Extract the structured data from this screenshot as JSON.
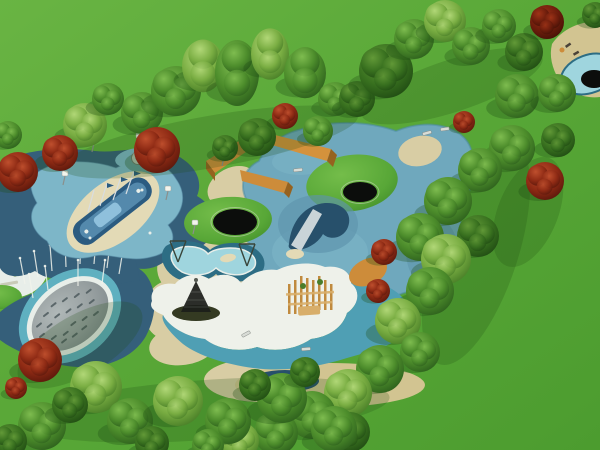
{
  "meta": {
    "description": "Aerial 3D rendering of a children's playground park with tree bands, navy and blue safety surfacing, splash pad with water jets, wading pool, white lagoon with cone climber, trampolines, orange wall and corner pool"
  },
  "palette": {
    "shadow": "#1e4c14",
    "navy": "#355f7a",
    "navyDeep": "#27506b",
    "blueLight": "#7db6c8",
    "blueMid": "#6fa8bd",
    "blueSteel": "#5d93ac",
    "blueEdge": "#4a8aa2",
    "poolBorder": "#2d6d84",
    "poolWater": "#9fd5de",
    "rim": "#e8eee9",
    "tealBand": "#4f9fb4",
    "tealRing": "#5fb0c0",
    "sand": "#d8cda4",
    "sandLight": "#e3dab6",
    "tanDeck": "#d2c491",
    "white": "#eef1ea",
    "grayDash": "#4e5a5e",
    "orange": "#cd8c3a",
    "orangeBright": "#d4923c",
    "orangeDark": "#96621f",
    "hull": "#2b5b80",
    "hullLight": "#5c92b4",
    "cabin": "#8fc0dc",
    "cone": "#1c1e1a",
    "mound": "#343a22",
    "structTan": "#c08a3e",
    "structTanLight": "#d8ae6a",
    "structGreen": "#4a7d2a",
    "lamp": "#f2f4ec",
    "pole": "#8a8f8c",
    "slide": "#c9d4d8",
    "black": "#0c0d0c",
    "benchGray": "#d8dcd6",
    "frame": "#39453a",
    "deckItemDark": "#4a4238"
  },
  "gradients": {
    "grassBG": {
      "type": "linear",
      "stops": [
        [
          "0%",
          "#69b443"
        ],
        [
          "55%",
          "#57a636"
        ],
        [
          "100%",
          "#4c9c2f"
        ]
      ]
    },
    "tree_g": {
      "type": "radial",
      "stops": [
        [
          "0%",
          "#7fbd50"
        ],
        [
          "55%",
          "#4c8c2b"
        ],
        [
          "100%",
          "#27571a"
        ]
      ]
    },
    "tree_l": {
      "type": "radial",
      "stops": [
        [
          "0%",
          "#b2d878"
        ],
        [
          "55%",
          "#79ad42"
        ],
        [
          "100%",
          "#3f7522"
        ]
      ]
    },
    "tree_d": {
      "type": "radial",
      "stops": [
        [
          "0%",
          "#639a38"
        ],
        [
          "55%",
          "#38701f"
        ],
        [
          "100%",
          "#1c4511"
        ]
      ]
    },
    "tree_r": {
      "type": "radial",
      "stops": [
        [
          "0%",
          "#c0502e"
        ],
        [
          "55%",
          "#8e2a14"
        ],
        [
          "100%",
          "#50140a"
        ]
      ]
    },
    "tree_rd": {
      "type": "radial",
      "stops": [
        [
          "0%",
          "#a03418"
        ],
        [
          "55%",
          "#6d1d0c"
        ],
        [
          "100%",
          "#3d0f05"
        ]
      ]
    },
    "padGrad": {
      "type": "radial",
      "stops": [
        [
          "0%",
          "#b0b8b8"
        ],
        [
          "60%",
          "#979fa0"
        ],
        [
          "100%",
          "#7f898c"
        ]
      ]
    },
    "moundGrad": {
      "type": "radial",
      "stops": [
        [
          "0%",
          "#74bd4a"
        ],
        [
          "70%",
          "#58a737"
        ],
        [
          "100%",
          "#44902c"
        ]
      ]
    }
  },
  "trees": [
    [
      8,
      135,
      14,
      "g"
    ],
    [
      85,
      125,
      22,
      "l"
    ],
    [
      108,
      99,
      16,
      "g"
    ],
    [
      60,
      153,
      18,
      "r"
    ],
    [
      18,
      172,
      20,
      "r"
    ],
    [
      142,
      113,
      21,
      "g"
    ],
    [
      157,
      150,
      23,
      "r"
    ],
    [
      176,
      91,
      25,
      "g"
    ],
    [
      203,
      66,
      21,
      "l",
      1.25
    ],
    [
      237,
      73,
      22,
      "g",
      1.5
    ],
    [
      270,
      54,
      19,
      "l",
      1.35
    ],
    [
      305,
      73,
      21,
      "g",
      1.2
    ],
    [
      335,
      99,
      17,
      "g"
    ],
    [
      225,
      148,
      13,
      "d"
    ],
    [
      257,
      137,
      19,
      "d"
    ],
    [
      285,
      116,
      13,
      "r"
    ],
    [
      318,
      131,
      15,
      "g"
    ],
    [
      357,
      99,
      18,
      "d"
    ],
    [
      386,
      71,
      27,
      "d"
    ],
    [
      414,
      39,
      20,
      "g"
    ],
    [
      445,
      21,
      21,
      "l"
    ],
    [
      471,
      46,
      19,
      "g"
    ],
    [
      499,
      26,
      17,
      "g"
    ],
    [
      524,
      52,
      19,
      "d"
    ],
    [
      547,
      22,
      17,
      "rd"
    ],
    [
      595,
      15,
      13,
      "d"
    ],
    [
      517,
      96,
      22,
      "g"
    ],
    [
      557,
      93,
      19,
      "g"
    ],
    [
      512,
      148,
      23,
      "g"
    ],
    [
      558,
      140,
      17,
      "d"
    ],
    [
      545,
      181,
      19,
      "r"
    ],
    [
      480,
      170,
      22,
      "g"
    ],
    [
      464,
      122,
      11,
      "r"
    ],
    [
      448,
      201,
      24,
      "g"
    ],
    [
      420,
      237,
      24,
      "g"
    ],
    [
      384,
      252,
      13,
      "r"
    ],
    [
      378,
      291,
      12,
      "r"
    ],
    [
      478,
      236,
      21,
      "d"
    ],
    [
      446,
      259,
      25,
      "l"
    ],
    [
      430,
      291,
      24,
      "g"
    ],
    [
      398,
      321,
      23,
      "l"
    ],
    [
      420,
      352,
      20,
      "g"
    ],
    [
      380,
      369,
      24,
      "g"
    ],
    [
      348,
      393,
      24,
      "l"
    ],
    [
      312,
      415,
      24,
      "g"
    ],
    [
      350,
      432,
      20,
      "d"
    ],
    [
      276,
      433,
      22,
      "g"
    ],
    [
      240,
      441,
      19,
      "l"
    ],
    [
      40,
      360,
      22,
      "r"
    ],
    [
      16,
      388,
      11,
      "r"
    ],
    [
      96,
      387,
      26,
      "l"
    ],
    [
      42,
      426,
      24,
      "g"
    ],
    [
      130,
      421,
      23,
      "g"
    ],
    [
      178,
      401,
      25,
      "l"
    ],
    [
      228,
      421,
      23,
      "g"
    ],
    [
      282,
      398,
      25,
      "g"
    ],
    [
      152,
      443,
      17,
      "d"
    ],
    [
      208,
      445,
      16,
      "g"
    ],
    [
      334,
      429,
      23,
      "g"
    ],
    [
      10,
      441,
      17,
      "d"
    ],
    [
      70,
      405,
      18,
      "d"
    ],
    [
      255,
      385,
      16,
      "d"
    ],
    [
      305,
      372,
      15,
      "d"
    ]
  ],
  "shadowBands": [
    [
      210,
      142,
      150,
      26,
      -10
    ],
    [
      452,
      86,
      95,
      26,
      -18
    ],
    [
      476,
      252,
      42,
      118,
      18
    ],
    [
      205,
      410,
      185,
      30,
      -4
    ],
    [
      528,
      212,
      30,
      58,
      22
    ],
    [
      80,
      345,
      70,
      30,
      -30
    ]
  ],
  "trampolines": [
    [
      235,
      222,
      22,
      13
    ],
    [
      360,
      192,
      17,
      10
    ]
  ],
  "lamps": [
    [
      92,
      152
    ],
    [
      137,
      147
    ],
    [
      63,
      185
    ],
    [
      166,
      200
    ],
    [
      222,
      166
    ],
    [
      193,
      234
    ]
  ],
  "benches": [
    [
      427,
      133,
      -15
    ],
    [
      445,
      129,
      -8
    ],
    [
      298,
      170,
      -6
    ],
    [
      246,
      334,
      -28
    ],
    [
      306,
      349,
      -4
    ]
  ],
  "jets": [
    [
      25,
      284,
      20,
      258
    ],
    [
      38,
      277,
      34,
      251
    ],
    [
      52,
      271,
      50,
      245
    ],
    [
      66,
      267,
      65,
      241
    ],
    [
      80,
      264,
      81,
      238
    ],
    [
      94,
      264,
      96,
      240
    ],
    [
      107,
      268,
      110,
      244
    ],
    [
      119,
      274,
      123,
      250
    ],
    [
      48,
      290,
      45,
      266
    ],
    [
      78,
      286,
      78,
      260
    ],
    [
      102,
      284,
      105,
      260
    ],
    [
      33,
      298,
      29,
      274
    ]
  ],
  "padDashes": [
    [
      -30,
      -12
    ],
    [
      -18,
      -16
    ],
    [
      -6,
      -19
    ],
    [
      6,
      -16
    ],
    [
      18,
      -12
    ],
    [
      30,
      -8
    ],
    [
      -34,
      -2
    ],
    [
      -22,
      -5
    ],
    [
      -10,
      -8
    ],
    [
      2,
      -5
    ],
    [
      14,
      -2
    ],
    [
      26,
      2
    ],
    [
      -26,
      7
    ],
    [
      -14,
      11
    ],
    [
      -2,
      8
    ],
    [
      10,
      11
    ],
    [
      22,
      14
    ],
    [
      -8,
      18
    ],
    [
      4,
      18
    ],
    [
      -20,
      16
    ]
  ]
}
